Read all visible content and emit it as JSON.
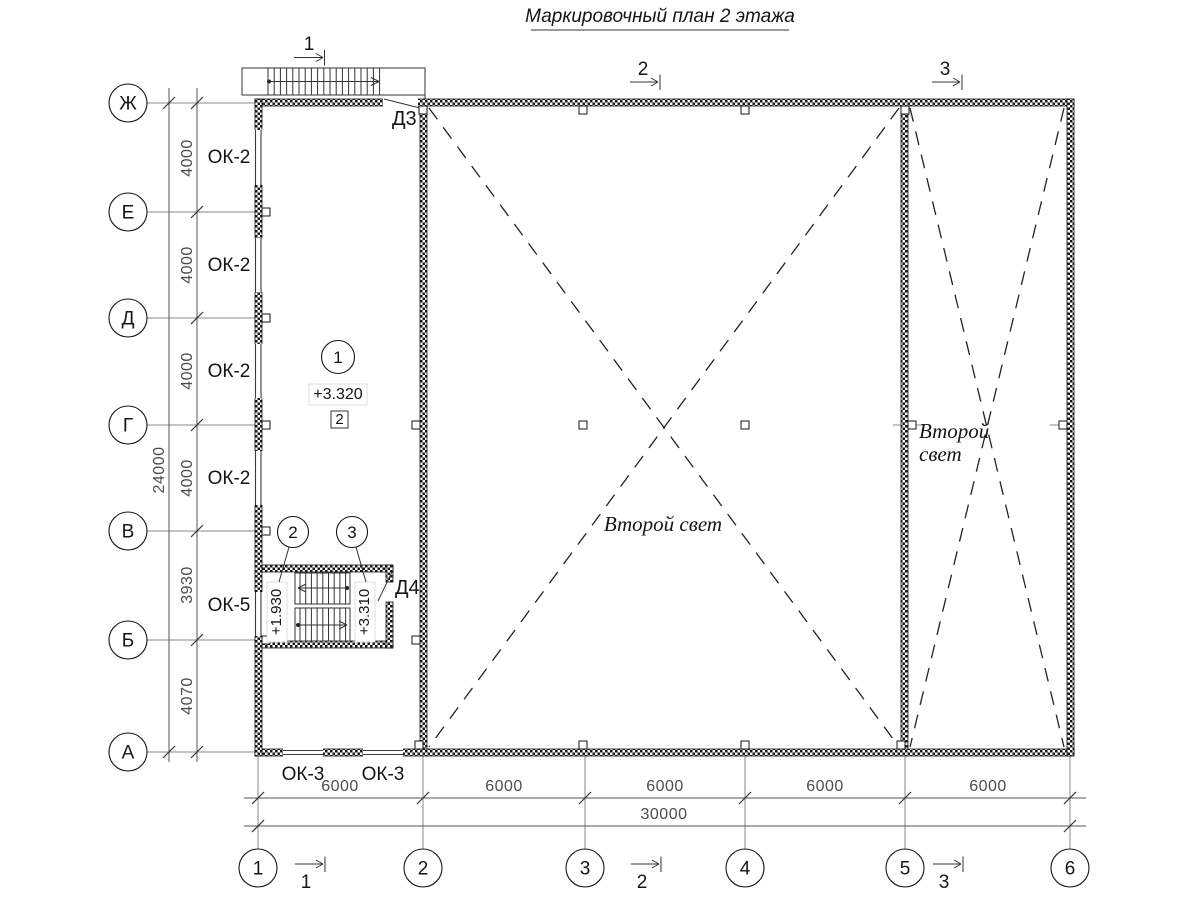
{
  "title": "Маркировочный план 2 этажа",
  "row_axes": [
    "Ж",
    "Е",
    "Д",
    "Г",
    "В",
    "Б",
    "А"
  ],
  "col_axes": [
    "1",
    "2",
    "3",
    "4",
    "5",
    "6"
  ],
  "dims_left": {
    "segments": [
      "4000",
      "4000",
      "4000",
      "4000",
      "3930",
      "4070"
    ],
    "total": "24000"
  },
  "dims_bottom": {
    "segments": [
      "6000",
      "6000",
      "6000",
      "6000",
      "6000"
    ],
    "total": "30000"
  },
  "windows": {
    "left": [
      "ОК-2",
      "ОК-2",
      "ОК-2",
      "ОК-2"
    ],
    "stair": "ОК-5",
    "bottom": [
      "ОК-3",
      "ОК-3"
    ]
  },
  "doors": {
    "top": "Д3",
    "stair": "Д4"
  },
  "levels": {
    "floor": "+3.320",
    "stair_landing": "+1.930",
    "stair_top": "+3.310"
  },
  "tags": {
    "room_circle": "1",
    "room_square": "2",
    "stair_circle_left": "2",
    "stair_circle_right": "3"
  },
  "texts": {
    "second_light": "Второй свет",
    "second_light_l1": "Второй",
    "second_light_l2": "свет"
  },
  "sections": {
    "top": [
      "1",
      "2",
      "3"
    ],
    "bottom": [
      "1",
      "2",
      "3"
    ]
  }
}
